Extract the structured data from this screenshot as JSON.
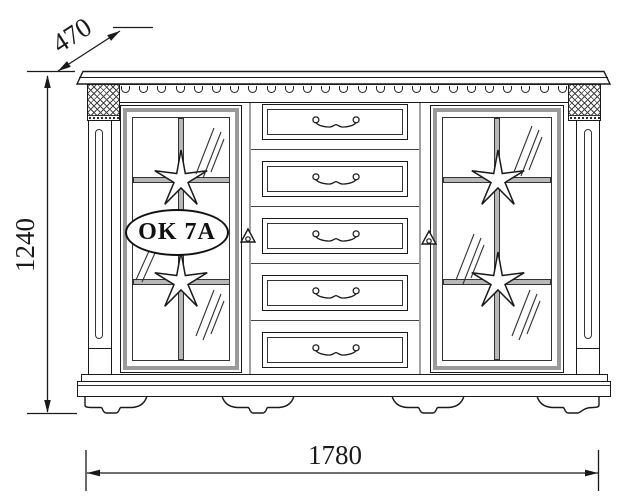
{
  "drawing": {
    "model_label": "OK 7A",
    "dimensions": {
      "width": "1780",
      "height": "1240",
      "depth": "470"
    },
    "structure": {
      "drawer_count": 5,
      "door_count": 2,
      "feet_count": 4,
      "star_count": 4,
      "scallop_count": 25
    },
    "colors": {
      "line": "#1a1a1a",
      "frame_gray": "#9a9a9a",
      "muntin_gray": "#b8b8b8",
      "background": "#ffffff"
    }
  }
}
